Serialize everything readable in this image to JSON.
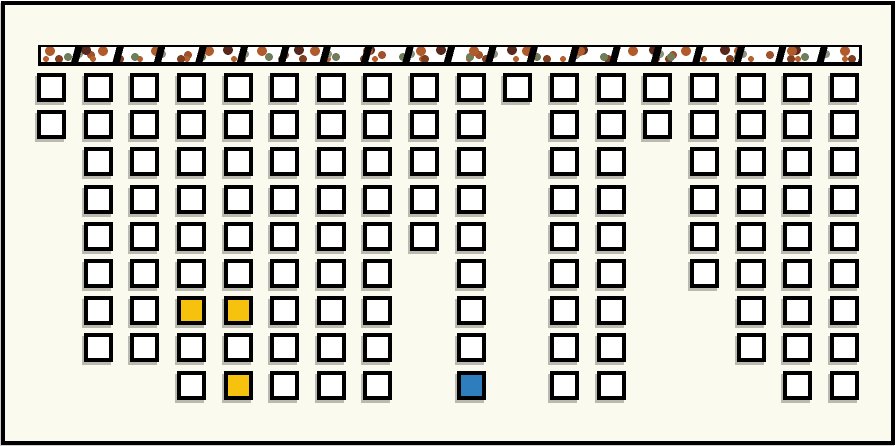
{
  "page": {
    "background_color": "#FBFAEE",
    "frame_border_color": "#000000"
  },
  "texture_strip": {
    "base_color": "#FFFFFF",
    "border_color": "#000000",
    "slash_color": "#000000",
    "dot_colors": [
      "#AF5B2B",
      "#6F7D5A",
      "#59281C",
      "#C8854C",
      "#7E4020",
      "#8A9480",
      "#B5622F",
      "#A0522D"
    ]
  },
  "grid": {
    "columns": 18,
    "rows": 9,
    "cell_fill": "#FFFFFF",
    "cell_border": "#000000",
    "rows_per_column": [
      2,
      8,
      8,
      9,
      9,
      9,
      9,
      9,
      5,
      9,
      1,
      9,
      9,
      2,
      6,
      8,
      9,
      9
    ],
    "highlighted_cells": [
      {
        "col": 4,
        "row": 7,
        "state": "yellow",
        "color": "#F7C20E"
      },
      {
        "col": 5,
        "row": 7,
        "state": "yellow",
        "color": "#F7C20E"
      },
      {
        "col": 5,
        "row": 9,
        "state": "yellow",
        "color": "#F7C20E"
      },
      {
        "col": 10,
        "row": 9,
        "state": "blue",
        "color": "#2E7EBD"
      }
    ]
  }
}
